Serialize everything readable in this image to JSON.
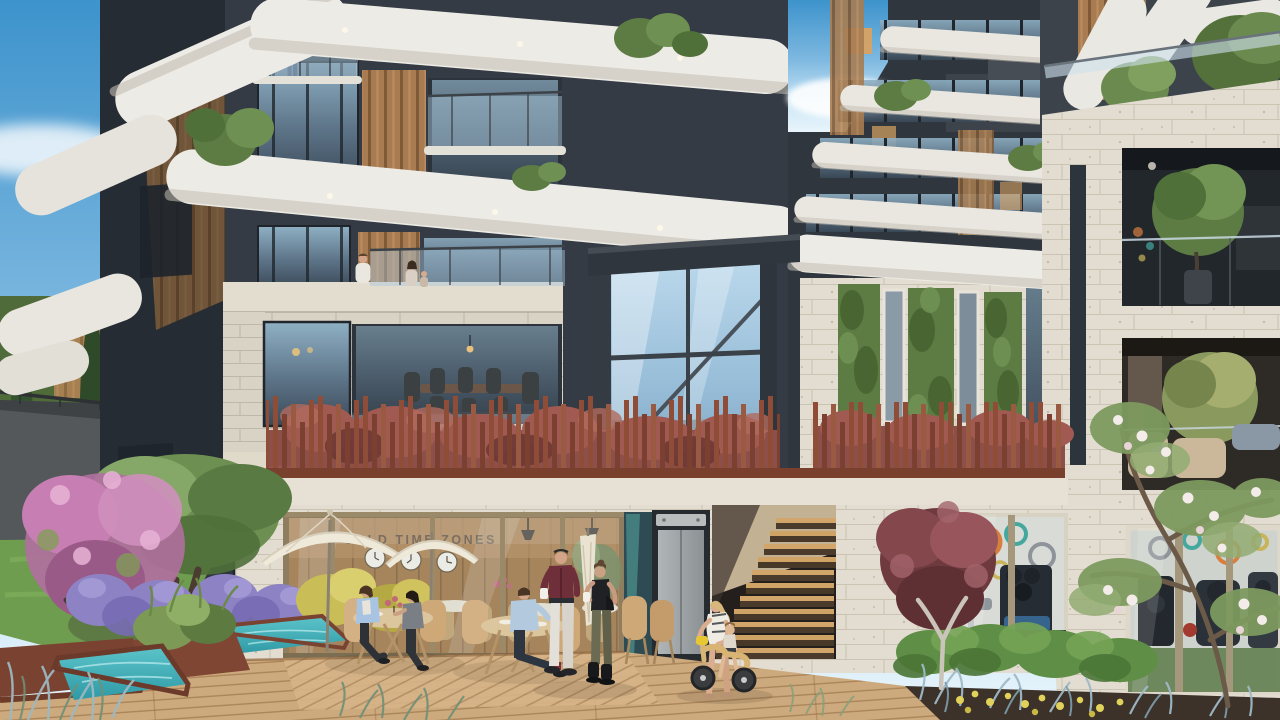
{
  "scene": {
    "setting": "Architectural rendering of a modern residential complex courtyard in daylight",
    "signage": {
      "cafe_wall_text": "ORLD TIME ZONES"
    },
    "palette": {
      "sky_top": "#3d93cc",
      "sky_horizon": "#cfe9f7",
      "band_white": "#edebe5",
      "band_shade": "#c3bdb2",
      "facade_dark": "#343b44",
      "facade_shadow": "#262c33",
      "timber": "#a87c50",
      "stone": "#d9d3c5",
      "travertine": "#e2ddd0",
      "glass_blue": "#a4c6de",
      "corten": "#8f4d38",
      "red_shrub": "#94544e",
      "green_wall": "#5d7c44",
      "lawn": "#6f9d4f",
      "lavender": "#8d83c4",
      "pool_water": "#3fb2bc",
      "deck_wood": "#cfad80",
      "stair_wood": "#cda167",
      "umbrella": "#efe9da",
      "gym_orange": "#d87f3f",
      "gym_teal": "#44a89e"
    },
    "buildings": {
      "main_tower": "curved white balcony bands, dark facade, timber slats, glass balconies with plants",
      "side_wing": "stacked thin white balcony bands receding right",
      "stone_annex": "stone volume with living green walls between windows",
      "right_building": "travertine facade with recessed planted balconies and rooftop trees",
      "glass_atrium": "full-height glazed lift/stair core reflecting the sky"
    },
    "amenities": [
      "terrace cafe with cream umbrellas",
      "world-time-zones clock wall inside cafe",
      "fitness room behind glazing with colourful ring mural",
      "turquoise reflecting pools in corten planters",
      "timber deck walkway",
      "corten vertical-slat fence over red shrubs",
      "outdoor timber stair",
      "lift with grey door"
    ],
    "landscape": [
      "lawn",
      "lavender beds",
      "yellow shrubs",
      "red ornamental grasses",
      "burgundy trees",
      "olive tree",
      "pink flowering tree",
      "white flowering tree",
      "cypresses",
      "box hedge",
      "blue grasses"
    ],
    "people": [
      {
        "name": "woman-on-balcony",
        "detail": "pink top and jeans at upper balcony railing"
      },
      {
        "name": "man-on-terrace",
        "detail": "white shirt behind glass parapet"
      },
      {
        "name": "woman-and-child-on-terrace",
        "detail": "standing beside the man"
      },
      {
        "name": "seated-woman-light-blue",
        "detail": "cafe table, light blue cardigan"
      },
      {
        "name": "seated-woman-grey",
        "detail": "cafe table, grey top"
      },
      {
        "name": "seated-man-denim",
        "detail": "cafe table, denim shirt, dark red socks"
      },
      {
        "name": "standing-man-burgundy",
        "detail": "burgundy shirt, white trousers, coffee cup"
      },
      {
        "name": "standing-woman-black-top",
        "detail": "black top, olive trousers, black boots, coffee cup"
      },
      {
        "name": "mother-white-dress",
        "detail": "bending to help toddler"
      },
      {
        "name": "toddler-on-balance-bike",
        "detail": "wooden balance bike with yellow handlebar pouch"
      }
    ]
  }
}
